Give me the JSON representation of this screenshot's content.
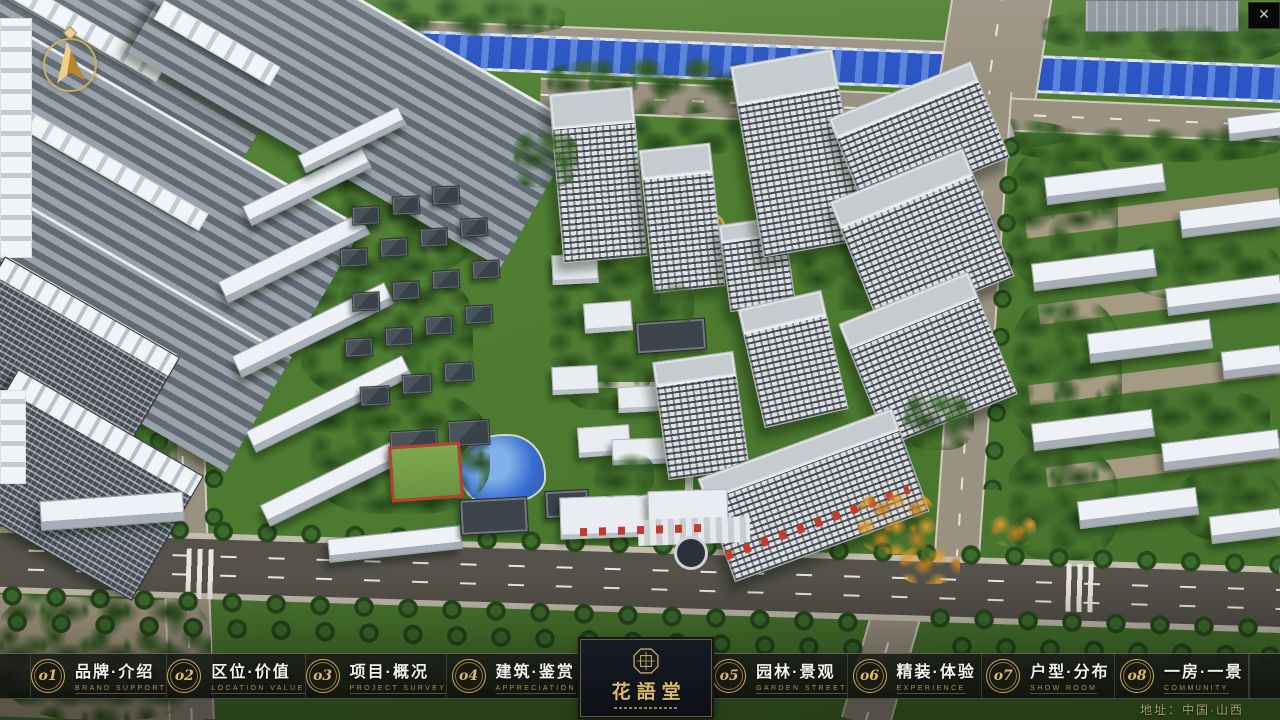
{
  "window": {
    "close_button": "✕"
  },
  "scene": {
    "palette": {
      "grass": "#4f7f33",
      "tree_dark": "#2c4e1e",
      "river_blue": "#2a55c4",
      "road_tan": "#9a9281",
      "asphalt": "#55524b",
      "tower_facade": "#dde1e4",
      "accent_gold": "#c9a95c",
      "navbar_bg": "#14160f"
    },
    "icons": {
      "compass": "north-arrow-compass",
      "seal": "octagonal-seal"
    }
  },
  "navbar": {
    "items": [
      {
        "num": "o1",
        "title": "品牌·介绍",
        "subtitle": "BRAND SUPPORT"
      },
      {
        "num": "o2",
        "title": "区位·价值",
        "subtitle": "LOCATION VALUE"
      },
      {
        "num": "o3",
        "title": "项目·概况",
        "subtitle": "PROJECT SURVEY"
      },
      {
        "num": "o4",
        "title": "建筑·鉴赏",
        "subtitle": "APPRECIATION"
      },
      {
        "num": "o5",
        "title": "园林·景观",
        "subtitle": "GARDEN STREET"
      },
      {
        "num": "o6",
        "title": "精装·体验",
        "subtitle": "EXPERIENCE"
      },
      {
        "num": "o7",
        "title": "户型·分布",
        "subtitle": "SHOW ROOM"
      },
      {
        "num": "o8",
        "title": "一房·一景",
        "subtitle": "COMMUNITY"
      }
    ],
    "logo": {
      "title": "花語堂"
    }
  },
  "footer": {
    "address": "地址：中国·山西"
  }
}
